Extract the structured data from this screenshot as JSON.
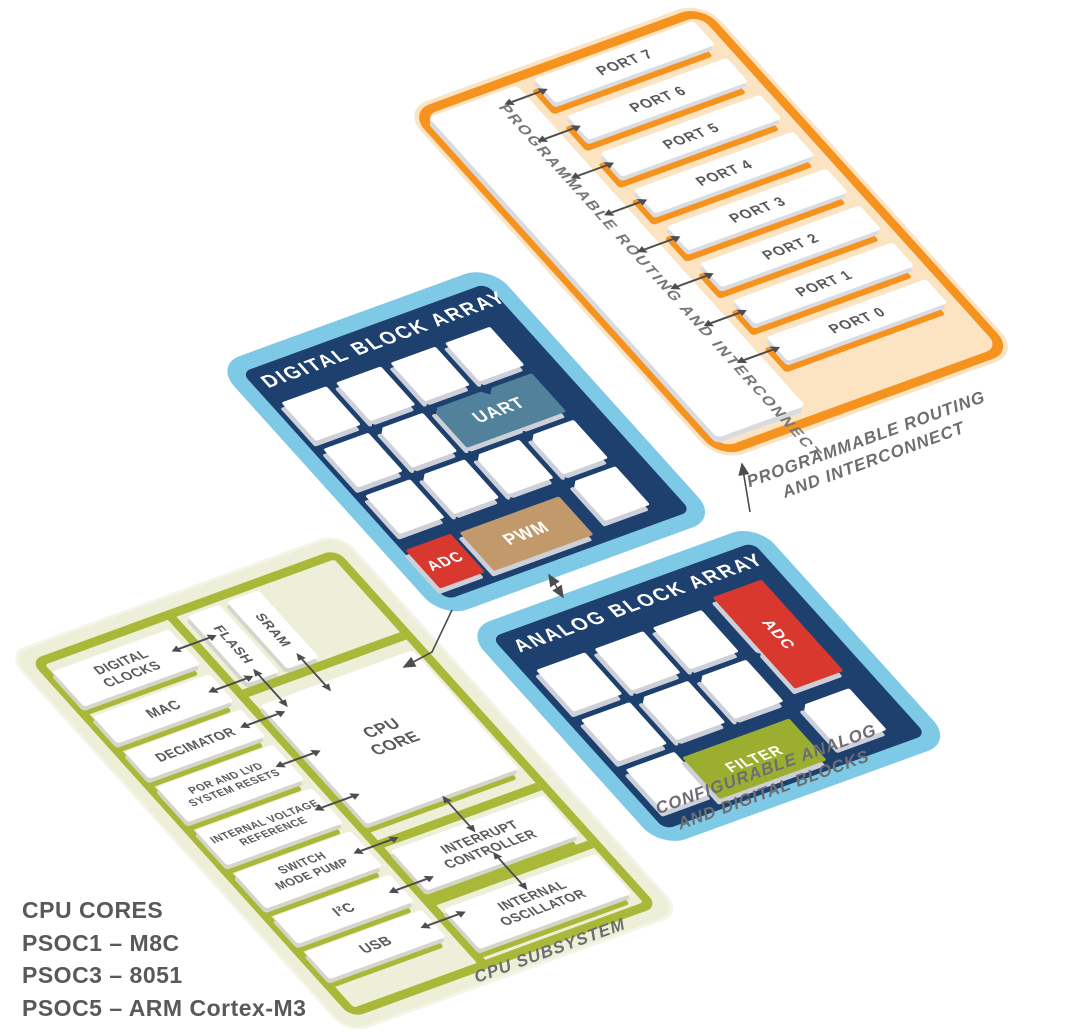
{
  "routing": {
    "strip_label": "PROGRAMMABLE ROUTING AND INTERCONNECT",
    "ports": [
      "PORT 7",
      "PORT 6",
      "PORT 5",
      "PORT 4",
      "PORT 3",
      "PORT 2",
      "PORT 1",
      "PORT 0"
    ],
    "caption": "PROGRAMMABLE ROUTING\nAND INTERCONNECT"
  },
  "digital": {
    "title": "DIGITAL BLOCK ARRAY",
    "uart": "UART",
    "adc": "ADC",
    "pwm": "PWM"
  },
  "analog": {
    "title": "ANALOG BLOCK ARRAY",
    "adc": "ADC",
    "filter": "FILTER",
    "caption": "CONFIGURABLE ANALOG\nAND DIGITAL BLOCKS"
  },
  "cpu": {
    "left_blocks": [
      "DIGITAL\nCLOCKS",
      "MAC",
      "DECIMATOR",
      "POR AND LVD\nSYSTEM RESETS",
      "INTERNAL VOLTAGE\nREFERENCE",
      "SWITCH\nMODE PUMP",
      "I²C",
      "USB"
    ],
    "flash": "FLASH",
    "sram": "SRAM",
    "cpu_core": "CPU\nCORE",
    "interrupt_controller": "INTERRUPT\nCONTROLLER",
    "internal_oscillator": "INTERNAL\nOSCILLATOR",
    "caption": "CPU SUBSYSTEM"
  },
  "legend": {
    "title": "CPU CORES",
    "items": [
      "PSOC1 – M8C",
      "PSOC3 – 8051",
      "PSOC5 – ARM Cortex-M3"
    ]
  },
  "colors": {
    "orange": "#F6921E",
    "orange_fill": "#FCE4C2",
    "sky_blue": "#7EC9E5",
    "navy": "#1D406F",
    "uart_blue": "#52819B",
    "adc_red": "#D9382F",
    "pwm_tan": "#C2996B",
    "filter_green": "#9CAE2F",
    "olive": "#A9B838",
    "cpu_fill": "#EDEFD8",
    "text_gray": "#58595B",
    "caption_gray": "#6D6E71",
    "arrow_gray": "#4D4D4F"
  }
}
